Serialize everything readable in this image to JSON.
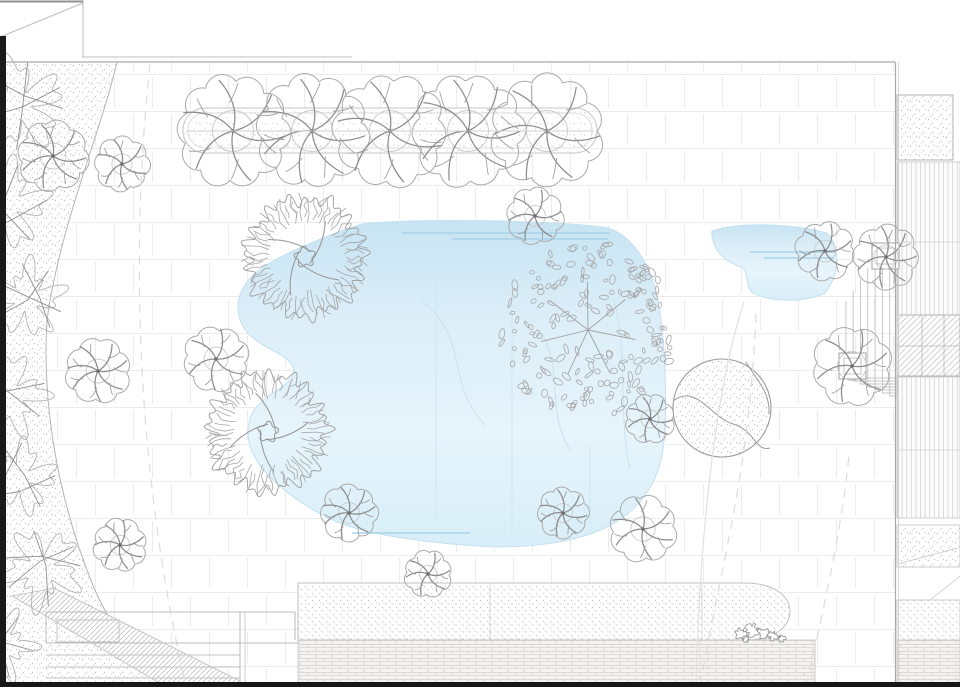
{
  "meta": {
    "drawing_type": "landscape-site-plan",
    "canvas": {
      "w": 960,
      "h": 687
    }
  },
  "colors": {
    "paper": "#ffffff",
    "paving_joint": "#ececec",
    "stipple_dot": "#c0c0c0",
    "boundary": "#a9a9a9",
    "frame_black": "#1a1a1a",
    "pond_deep": "#c7e4f3",
    "pond_mid": "#dceef8",
    "pond_light": "#e6f4fb",
    "ripple": "#a9d2e8",
    "tree_outline": "#aaaaaa",
    "branch": "#8c8c8c",
    "brick_line": "#c9c9c9",
    "deck_line": "#d7d7d7",
    "hatch_line": "#cccccc"
  },
  "zones": [
    {
      "name": "garden-paving-field",
      "shape": "rect",
      "x": 0,
      "y": 62,
      "w": 895,
      "h": 625,
      "fill": "paving",
      "stroke": "none",
      "sw": 0
    },
    {
      "name": "left-planting-strip",
      "shape": "path",
      "d": "M0,62 L117,62 C100,135 60,225 47,320 C42,400 56,495 94,588 C110,625 136,660 162,687 L0,687 Z",
      "fill": "st9",
      "stroke": "#b5b5b5",
      "sw": 1
    },
    {
      "name": "top-hedge-bed-outer",
      "shape": "rrect",
      "x": 183,
      "y": 108,
      "w": 414,
      "h": 45,
      "rx": 22,
      "fill": "st10",
      "stroke": "#c6c6c6",
      "sw": 1
    },
    {
      "name": "top-hedge-bed-inner",
      "shape": "rrect",
      "x": 188,
      "y": 113,
      "w": 404,
      "h": 35,
      "rx": 17,
      "fill": "none",
      "stroke": "#d4d4d4",
      "sw": 0.8
    },
    {
      "name": "main-pond",
      "shape": "path",
      "d": "M362,224 C410,218 560,220 608,228 C632,236 650,262 658,300 C666,345 668,420 662,455 C655,492 632,515 605,528 C570,544 520,549 478,546 C430,543 378,536 345,525 C315,514 282,492 262,468 C248,450 244,432 252,414 C260,398 278,392 290,380 C298,370 292,360 276,352 C252,340 240,330 238,310 C237,292 248,276 268,264 C292,250 330,234 362,224 Z",
      "fill": "pond",
      "stroke": "#c3e1f0",
      "sw": 1
    },
    {
      "name": "upper-pond",
      "shape": "path",
      "d": "M712,231 C738,222 790,223 827,233 C841,248 840,274 825,293 C804,303 769,302 753,293 C744,286 750,272 741,267 C723,261 711,248 712,231 Z",
      "fill": "pond",
      "stroke": "#c3e1f0",
      "sw": 1
    },
    {
      "name": "bottom-gravel-bed",
      "shape": "path",
      "d": "M298,583 L745,583 C775,583 790,597 790,611 C790,627 774,640 747,640 L298,640 Z",
      "fill": "st7",
      "stroke": "#c2c2c2",
      "sw": 1
    },
    {
      "name": "bottom-brick-paving",
      "shape": "rect",
      "x": 298,
      "y": 640,
      "w": 517,
      "h": 44,
      "fill": "brick",
      "stroke": "#bfbfbf",
      "sw": 0.8
    },
    {
      "name": "right-brick-paving",
      "shape": "rect",
      "x": 897,
      "y": 640,
      "w": 63,
      "h": 44,
      "fill": "brick",
      "stroke": "#bfbfbf",
      "sw": 0.8
    },
    {
      "name": "right-gravel-upper",
      "shape": "rect",
      "x": 897,
      "y": 95,
      "w": 56,
      "h": 65,
      "fill": "st9",
      "stroke": "#b3b3b3",
      "sw": 1
    },
    {
      "name": "right-deck-upper",
      "shape": "rect",
      "x": 897,
      "y": 162,
      "w": 63,
      "h": 153,
      "fill": "deck",
      "stroke": "#c6c6c6",
      "sw": 0.8
    },
    {
      "name": "right-glass-roof",
      "shape": "rect",
      "x": 897,
      "y": 315,
      "w": 63,
      "h": 61,
      "fill": "diag",
      "stroke": "#b3b3b3",
      "sw": 1
    },
    {
      "name": "right-deck-lower",
      "shape": "rect",
      "x": 897,
      "y": 377,
      "w": 63,
      "h": 141,
      "fill": "deck",
      "stroke": "#c6c6c6",
      "sw": 0.8
    },
    {
      "name": "right-gravel-mid",
      "shape": "rect",
      "x": 897,
      "y": 525,
      "w": 63,
      "h": 42,
      "fill": "st9",
      "stroke": "#c2c2c2",
      "sw": 0.8
    },
    {
      "name": "right-gravel-low",
      "shape": "rect",
      "x": 897,
      "y": 600,
      "w": 63,
      "h": 40,
      "fill": "st7",
      "stroke": "#c2c2c2",
      "sw": 0.8
    },
    {
      "name": "left-hatch-ramp",
      "shape": "polygon",
      "points": "12,596 54,588 240,681 240,687 166,687",
      "fill": "diagDense",
      "stroke": "#bdbdbd",
      "sw": 0.8
    }
  ],
  "water": {
    "ripples": [
      {
        "d": "M402,233 L610,233"
      },
      {
        "d": "M452,239 L608,239"
      },
      {
        "d": "M352,533 L470,533"
      },
      {
        "d": "M750,252 L836,252"
      },
      {
        "d": "M764,258 L834,258"
      }
    ],
    "seams": [
      {
        "d": "M436,252 L436,520"
      },
      {
        "d": "M512,255 L512,534"
      },
      {
        "d": "M590,445 L590,524"
      }
    ],
    "contours": [
      {
        "d": "M420,300 C470,335 445,385 485,425"
      },
      {
        "d": "M540,330 C565,370 545,410 570,450"
      },
      {
        "d": "M614,300 C628,350 618,420 630,468"
      }
    ]
  },
  "structures": {
    "planters": [
      {
        "x": 839,
        "y": 353,
        "w": 27,
        "h": 26
      },
      {
        "x": 872,
        "y": 243,
        "w": 27,
        "h": 26
      }
    ],
    "nested_steps": {
      "x": 897,
      "y0": 224,
      "count": 8,
      "dx": 7.3,
      "dy": 11,
      "ybase": 399,
      "dyb": 3
    },
    "sand_circle": {
      "cx": 722,
      "cy": 408,
      "r": 49,
      "curves": [
        "M673,401 C696,383 710,417 733,424 C756,431 755,452 770,448",
        "M746,362 C757,381 770,391 769,414"
      ]
    },
    "boulders": [
      {
        "x": 741,
        "y": 634,
        "r": 6
      },
      {
        "x": 752,
        "y": 630,
        "r": 7
      },
      {
        "x": 763,
        "y": 633,
        "r": 6
      },
      {
        "x": 773,
        "y": 636,
        "r": 5
      },
      {
        "x": 782,
        "y": 638,
        "r": 4
      },
      {
        "x": 746,
        "y": 639,
        "r": 3.5
      }
    ]
  },
  "trees": {
    "umbrella": [
      {
        "x": 233,
        "y": 131,
        "r": 57
      },
      {
        "x": 312,
        "y": 131,
        "r": 57
      },
      {
        "x": 390,
        "y": 131,
        "r": 57
      },
      {
        "x": 468,
        "y": 131,
        "r": 57
      },
      {
        "x": 547,
        "y": 131,
        "r": 57
      },
      {
        "x": 53,
        "y": 156,
        "r": 36
      },
      {
        "x": 122,
        "y": 164,
        "r": 28
      },
      {
        "x": 98,
        "y": 371,
        "r": 33
      },
      {
        "x": 216,
        "y": 359,
        "r": 33
      },
      {
        "x": 120,
        "y": 545,
        "r": 27
      },
      {
        "x": 535,
        "y": 216,
        "r": 29
      },
      {
        "x": 650,
        "y": 419,
        "r": 25,
        "layer": "under"
      },
      {
        "x": 825,
        "y": 251,
        "r": 30
      },
      {
        "x": 886,
        "y": 257,
        "r": 33
      },
      {
        "x": 852,
        "y": 366,
        "r": 40
      },
      {
        "x": 349,
        "y": 513,
        "r": 29
      },
      {
        "x": 428,
        "y": 574,
        "r": 24
      },
      {
        "x": 563,
        "y": 513,
        "r": 26
      },
      {
        "x": 643,
        "y": 529,
        "r": 34
      }
    ],
    "coral": [
      {
        "x": 305,
        "y": 257,
        "r": 66
      },
      {
        "x": 268,
        "y": 432,
        "r": 66
      }
    ],
    "leafy": [
      {
        "x": 588,
        "y": 330,
        "r": 88
      }
    ],
    "shrubs": [
      {
        "x": 18,
        "y": 105,
        "r": 56
      },
      {
        "x": 6,
        "y": 205,
        "r": 52
      },
      {
        "x": 26,
        "y": 300,
        "r": 46
      },
      {
        "x": 8,
        "y": 395,
        "r": 48
      },
      {
        "x": 20,
        "y": 478,
        "r": 44
      },
      {
        "x": 42,
        "y": 568,
        "r": 48
      },
      {
        "x": 0,
        "y": 645,
        "r": 42
      }
    ]
  },
  "lines": [
    {
      "name": "contour-dashed-left",
      "d": "M150,64 C130,250 136,470 186,686",
      "stroke": "#dcdcdc",
      "w": 1.2,
      "dash": "9 7"
    },
    {
      "name": "contour-dashed-right-1",
      "d": "M700,686 C722,560 750,470 756,312",
      "stroke": "#dcdcdc",
      "w": 1.2,
      "dash": "9 7"
    },
    {
      "name": "contour-dashed-right-2",
      "d": "M806,686 C826,600 843,520 849,455",
      "stroke": "#dcdcdc",
      "w": 1.2,
      "dash": "9 7"
    },
    {
      "name": "path-edge-curve",
      "d": "M744,302 C718,380 700,520 696,686",
      "stroke": "#e0e0e0",
      "w": 1.2
    },
    {
      "name": "hedge-bed-midline",
      "d": "M186,131 L594,131",
      "stroke": "#cfcfcf",
      "w": 0.9
    },
    {
      "name": "gravel-joint-1",
      "d": "M490,583 L490,640",
      "stroke": "#d6d6d6",
      "w": 0.9
    },
    {
      "name": "gravel-joint-2",
      "d": "M702,583 L702,640",
      "stroke": "#d6d6d6",
      "w": 0.9
    },
    {
      "name": "steps-left-top",
      "d": "M46,612 L295,612",
      "stroke": "#bdbdbd",
      "w": 1
    },
    {
      "name": "steps-left-edge",
      "d": "M46,612 L46,643",
      "stroke": "#bdbdbd",
      "w": 1
    },
    {
      "name": "steps-tread-1",
      "d": "M46,643 L298,643",
      "stroke": "#bdbdbd",
      "w": 1
    },
    {
      "name": "steps-tread-2",
      "d": "M46,655 L240,655",
      "stroke": "#c6c6c6",
      "w": 1
    },
    {
      "name": "steps-tread-3",
      "d": "M46,667 L240,667",
      "stroke": "#c6c6c6",
      "w": 1
    },
    {
      "name": "steps-tread-4",
      "d": "M46,678 L240,678",
      "stroke": "#c6c6c6",
      "w": 1
    },
    {
      "name": "steps-divider-a",
      "d": "M240,612 L240,687",
      "stroke": "#b9b9b9",
      "w": 1
    },
    {
      "name": "steps-divider-b",
      "d": "M245,612 L245,687",
      "stroke": "#cfcfcf",
      "w": 1
    },
    {
      "name": "steps-divider-c",
      "d": "M295,612 L295,640",
      "stroke": "#b9b9b9",
      "w": 1
    },
    {
      "name": "steps-landing",
      "d": "M57,620 L119,620 L119,642 L57,642 Z",
      "stroke": "#c0c0c0",
      "w": 0.9
    },
    {
      "name": "deck-upper-joint",
      "d": "M897,242 L960,242",
      "stroke": "#cfcfcf",
      "w": 0.8
    },
    {
      "name": "deck-lower-joint",
      "d": "M897,450 L960,450",
      "stroke": "#cfcfcf",
      "w": 0.8
    },
    {
      "name": "glass-roof-col-1",
      "d": "M922,315 L922,376",
      "stroke": "#b9b9b9",
      "w": 0.8
    },
    {
      "name": "glass-roof-col-2",
      "d": "M944,315 L944,376",
      "stroke": "#b9b9b9",
      "w": 0.8
    },
    {
      "name": "glass-roof-row",
      "d": "M897,346 L960,346",
      "stroke": "#b9b9b9",
      "w": 0.8
    },
    {
      "name": "right-chamfer-line",
      "d": "M898,564 L957,548",
      "stroke": "#c6c6c6",
      "w": 0.8
    },
    {
      "name": "right-walk-edge",
      "d": "M897,600 L930,600 L960,576",
      "stroke": "#c6c6c6",
      "w": 0.8
    },
    {
      "name": "boundary-top",
      "d": "M0,62 L895,62",
      "stroke": "#a9a9a9",
      "w": 1.3
    },
    {
      "name": "boundary-right-outer",
      "d": "M895.5,62 L895.5,687",
      "stroke": "#a9a9a9",
      "w": 1.2
    },
    {
      "name": "boundary-right-inner",
      "d": "M898.5,62 L898.5,687",
      "stroke": "#cfcfcf",
      "w": 0.9
    },
    {
      "name": "neighbor-wall-top",
      "d": "M82,57 L352,57",
      "stroke": "#bdbdbd",
      "w": 1
    },
    {
      "name": "neighbor-wall-vert",
      "d": "M83,0 L83,57",
      "stroke": "#bdbdbd",
      "w": 1
    },
    {
      "name": "neighbor-wall-diag",
      "d": "M83,3 L0,37",
      "stroke": "#bdbdbd",
      "w": 1
    },
    {
      "name": "top-edge-line",
      "d": "M0,1.5 L83,1.5",
      "stroke": "#8f8f8f",
      "w": 2
    }
  ],
  "frame": {
    "left_bar": {
      "x": 0,
      "y": 36,
      "w": 6,
      "h": 651
    },
    "bottom_bar": {
      "x": 0,
      "y": 682,
      "w": 960,
      "h": 5
    }
  }
}
